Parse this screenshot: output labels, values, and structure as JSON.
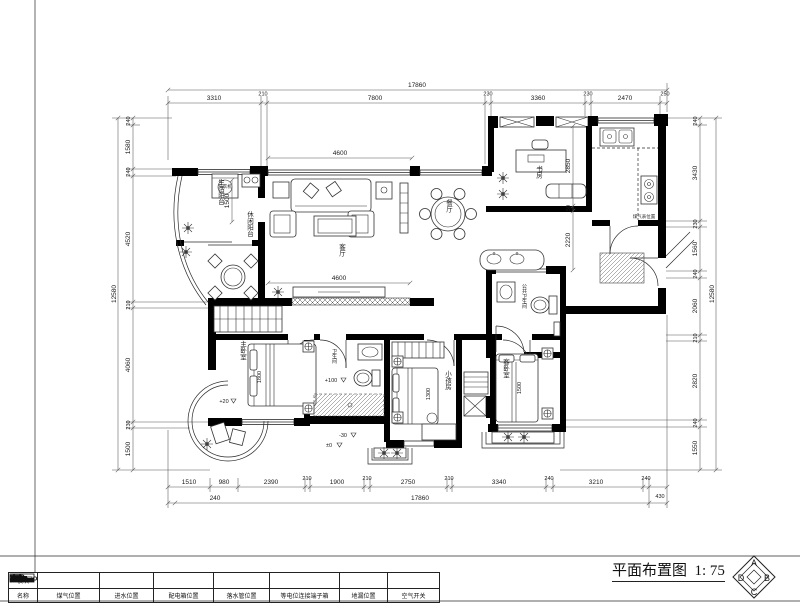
{
  "sheet": {
    "title": "平面布置图",
    "scale": "1: 75",
    "compass": {
      "top": "A",
      "right": "B",
      "bottom": "C",
      "left": "D"
    }
  },
  "legend": {
    "row_module": "模块",
    "row_name": "名称",
    "items": [
      {
        "icon": "gas-meter",
        "name": "煤气位置"
      },
      {
        "icon": "water-inlet",
        "name": "进水位置"
      },
      {
        "icon": "distribution-box",
        "name": "配电箱位置"
      },
      {
        "icon": "downpipe",
        "name": "落水管位置"
      },
      {
        "icon": "equipotential-terminal",
        "name": "等电位连接端子箱"
      },
      {
        "icon": "floor-drain",
        "name": "地漏位置"
      },
      {
        "icon": "air-switch",
        "name": "空气开关"
      }
    ]
  },
  "dimensions": {
    "top": {
      "overall": "17860",
      "segments": [
        "3310",
        "210",
        "7800",
        "230",
        "3360",
        "230",
        "2470",
        "250"
      ]
    },
    "bottom": {
      "overall": "17860",
      "left": "240",
      "right": "430",
      "segments": [
        "1510",
        "980",
        "2390",
        "210",
        "1900",
        "210",
        "2750",
        "210",
        "3340",
        "240",
        "3210",
        "240"
      ]
    },
    "left": {
      "overall": "12580",
      "segments": [
        "240",
        "1580",
        "240",
        "4520",
        "210",
        "4060",
        "230",
        "1500"
      ]
    },
    "right": {
      "overall": "12580",
      "segments": [
        "240",
        "3430",
        "230",
        "1560",
        "240",
        "2060",
        "210",
        "2820",
        "240",
        "1550"
      ]
    }
  },
  "rooms": {
    "service_balcony": "生活阳台",
    "leisure_balcony": "休闲阳台",
    "living": "客厅",
    "dining": "餐厅",
    "study": "书房",
    "public_bath": "公共卫生间",
    "master": "主卧室",
    "bath": "卫生间",
    "child": "小孩房",
    "guest": "客卧室",
    "washer": "洗衣机",
    "gas_note": "煤气表位置"
  },
  "inner_dims": {
    "living_top": "4600",
    "living_bottom": "4600",
    "balcony_width": "1500",
    "study_depth": "2850",
    "study_gap": "50",
    "dining_depth": "2220",
    "master_bed": "1800",
    "child_bed": "1300",
    "guest_bed": "1500"
  },
  "levels": {
    "balcony": "+20",
    "bath": "+100",
    "hall_minus": "-30",
    "hall_zero": "±0"
  }
}
